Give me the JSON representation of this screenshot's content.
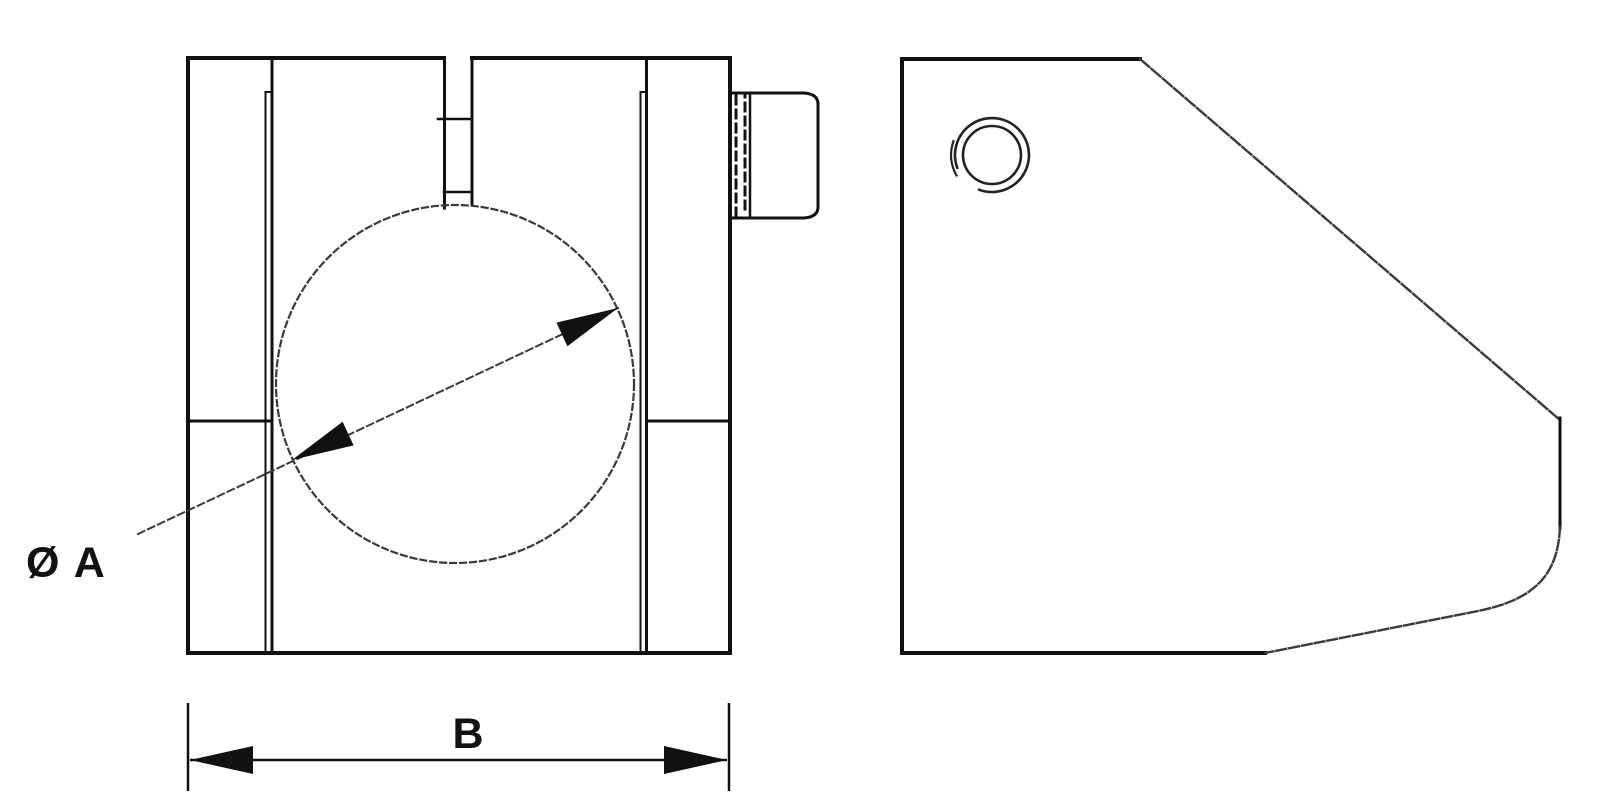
{
  "drawing": {
    "background_color": "#ffffff",
    "line_color": "#1a1a1a",
    "labels": {
      "diameter": "Ø A",
      "width": "B"
    }
  }
}
